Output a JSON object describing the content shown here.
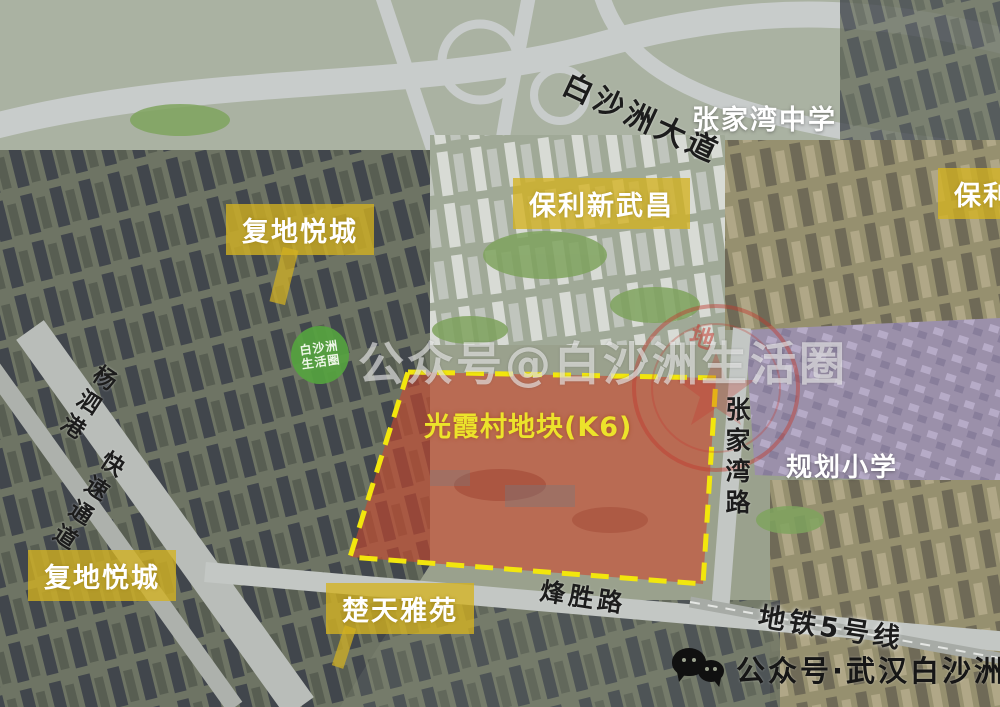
{
  "colors": {
    "label_yellow_bg": "rgba(212,178,32,0.78)",
    "label_text": "#ffffff",
    "parcel_fill": "rgba(207,72,45,0.60)",
    "parcel_border_yellow": "#f2e60d",
    "site_text_yellow": "#ece32b",
    "road_text_black": "#1c1c1c",
    "badge_green": "#55a33f",
    "stamp_red": "#c2392f",
    "watermark_white": "rgba(255,255,255,0.55)"
  },
  "places": {
    "fudi_top": "复地悦城",
    "fudi_bottom": "复地悦城",
    "baoli_xinwuchang": "保利新武昌",
    "baoli_right_partial": "保利",
    "chutian_yayuan": "楚天雅苑",
    "zhangjiawan_school": "张家湾中学",
    "planned_primary_school": "规划小学",
    "site_parcel": "光霞村地块(K6)"
  },
  "roads": {
    "baishazhou_avenue": "白沙洲大道",
    "zhangjiawan_road": "张家湾路",
    "fengsheng_road": "烽胜路",
    "metro_line_5": "地铁5号线",
    "yangsigang_upper": "杨泗港",
    "yangsigang_lower": "快速通道"
  },
  "watermarks": {
    "center": "公众号@白沙洲生活圈",
    "badge_top": "白沙洲",
    "badge_bottom": "生活圈",
    "bottom_right": "公众号·武汉白沙洲",
    "stamp_visible_char": "地"
  }
}
